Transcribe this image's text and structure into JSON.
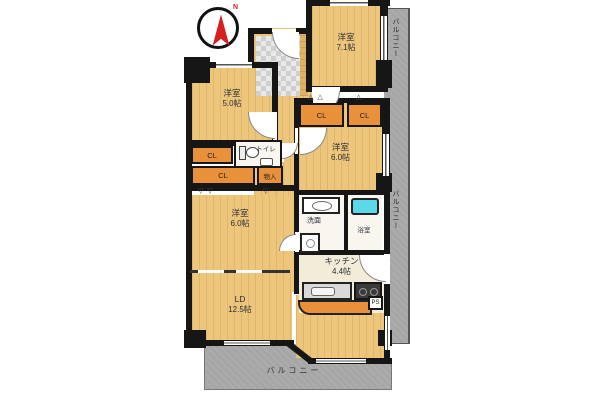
{
  "compass": {
    "label": "N"
  },
  "rooms": {
    "room_71": {
      "name": "洋室",
      "size": "7.1帖"
    },
    "room_50": {
      "name": "洋室",
      "size": "5.0帖"
    },
    "room_60e": {
      "name": "洋室",
      "size": "6.0帖"
    },
    "room_60w": {
      "name": "洋室",
      "size": "6.0帖"
    },
    "ld": {
      "name": "LD",
      "size": "12.5帖"
    },
    "kitchen": {
      "name": "キッチン",
      "size": "4.4帖"
    }
  },
  "labels": {
    "closet": "CL",
    "storage": "物入",
    "toilet": "トイレ",
    "washroom": "洗面",
    "bathroom": "浴室",
    "pipe_shaft": "PS",
    "balcony": "バルコニー"
  },
  "colors": {
    "floor_wood": "#edc67c",
    "closet_orange": "#e8913a",
    "balcony_gray": "#a6a6a6",
    "wall_black": "#161616",
    "kitchen_cream": "#f2ecd8",
    "bath_tub_cyan": "#5cd9e8",
    "compass_red": "#d42020"
  }
}
